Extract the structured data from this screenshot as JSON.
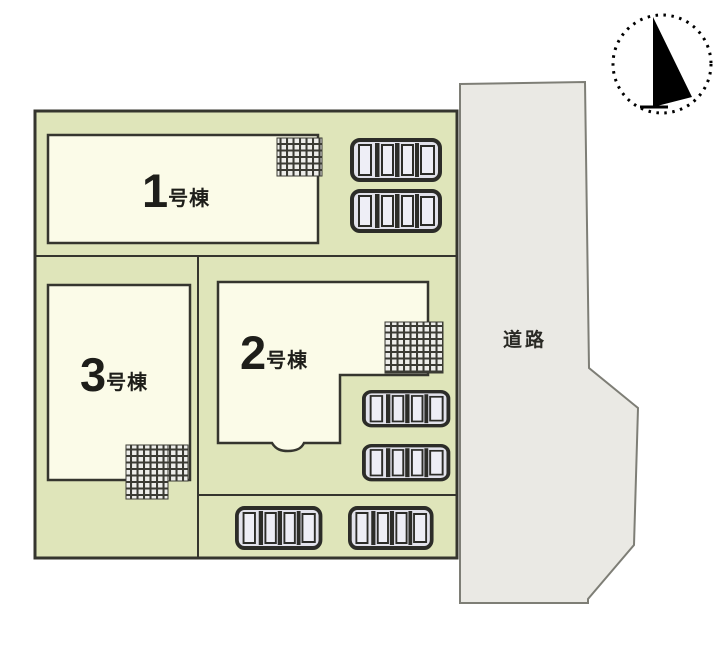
{
  "site_plan": {
    "buildings": [
      {
        "name": "building-1",
        "number": "1",
        "suffix": "号棟"
      },
      {
        "name": "building-2",
        "number": "2",
        "suffix": "号棟"
      },
      {
        "name": "building-3",
        "number": "3",
        "suffix": "号棟"
      }
    ],
    "road_label": "道路",
    "parking": {
      "car_count": 8,
      "hatch_area_count": 4
    },
    "compass": {
      "points_to": "north"
    },
    "colors": {
      "site_green": "#dfe5ba",
      "building_cream": "#fbfbe8",
      "road_gray": "#eae9e4",
      "outline_dark": "#35352e",
      "car_body": "#e2e2eb"
    }
  }
}
